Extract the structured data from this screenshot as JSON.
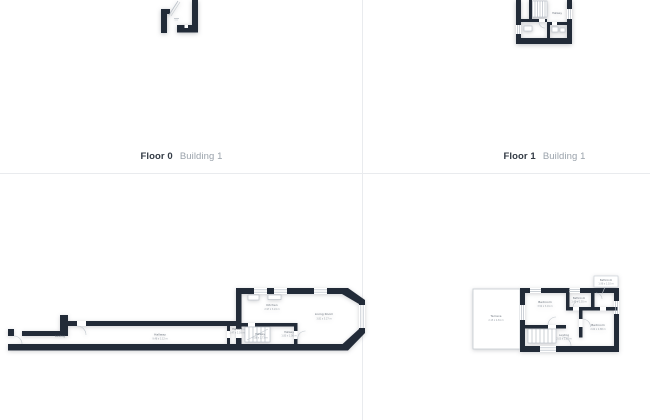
{
  "captions": [
    {
      "floor": "Floor 0",
      "building": "Building 1"
    },
    {
      "floor": "Floor 1",
      "building": "Building 1"
    }
  ],
  "palette": {
    "background": "#ffffff",
    "divider": "#e9ebee",
    "wall": "#222b38",
    "fixture_line": "#b6bdc5",
    "room_label": "#6f7780",
    "dim_label": "#9aa1a9",
    "caption_floor": "#333b45",
    "caption_building": "#9aa2ab"
  },
  "plans": {
    "floor1_preview": {
      "label": "Hallway"
    },
    "floor0_main": {
      "rooms": [
        {
          "name": "Landing",
          "dims": ""
        },
        {
          "name": "Hallway",
          "dims": "9.48 x 1.12 m"
        },
        {
          "name": "Kitchen",
          "dims": "2.97 x 3.24 m"
        },
        {
          "name": "Hallway",
          "dims": "1.47 x 2.03 m"
        },
        {
          "name": "Hallway",
          "dims": "0.88 x 1.73 m"
        },
        {
          "name": "Hallway",
          "dims": "1.83 x 1.08 m"
        },
        {
          "name": "Living Room",
          "dims": "3.81 x 5.27 m"
        }
      ]
    },
    "floor1_main": {
      "rooms": [
        {
          "name": "Terrace",
          "dims": "2.15 x 4.81 m"
        },
        {
          "name": "Bedroom",
          "dims": "3.52 x 3.01 m"
        },
        {
          "name": "Bathroom",
          "dims": "1.45 x 1.55 m"
        },
        {
          "name": "Bathroom",
          "dims": "1.98 x 1.10 m"
        },
        {
          "name": "Bedroom",
          "dims": "2.62 x 2.88 m"
        },
        {
          "name": "Landing",
          "dims": "2.05 x 1.87 m"
        }
      ]
    }
  }
}
